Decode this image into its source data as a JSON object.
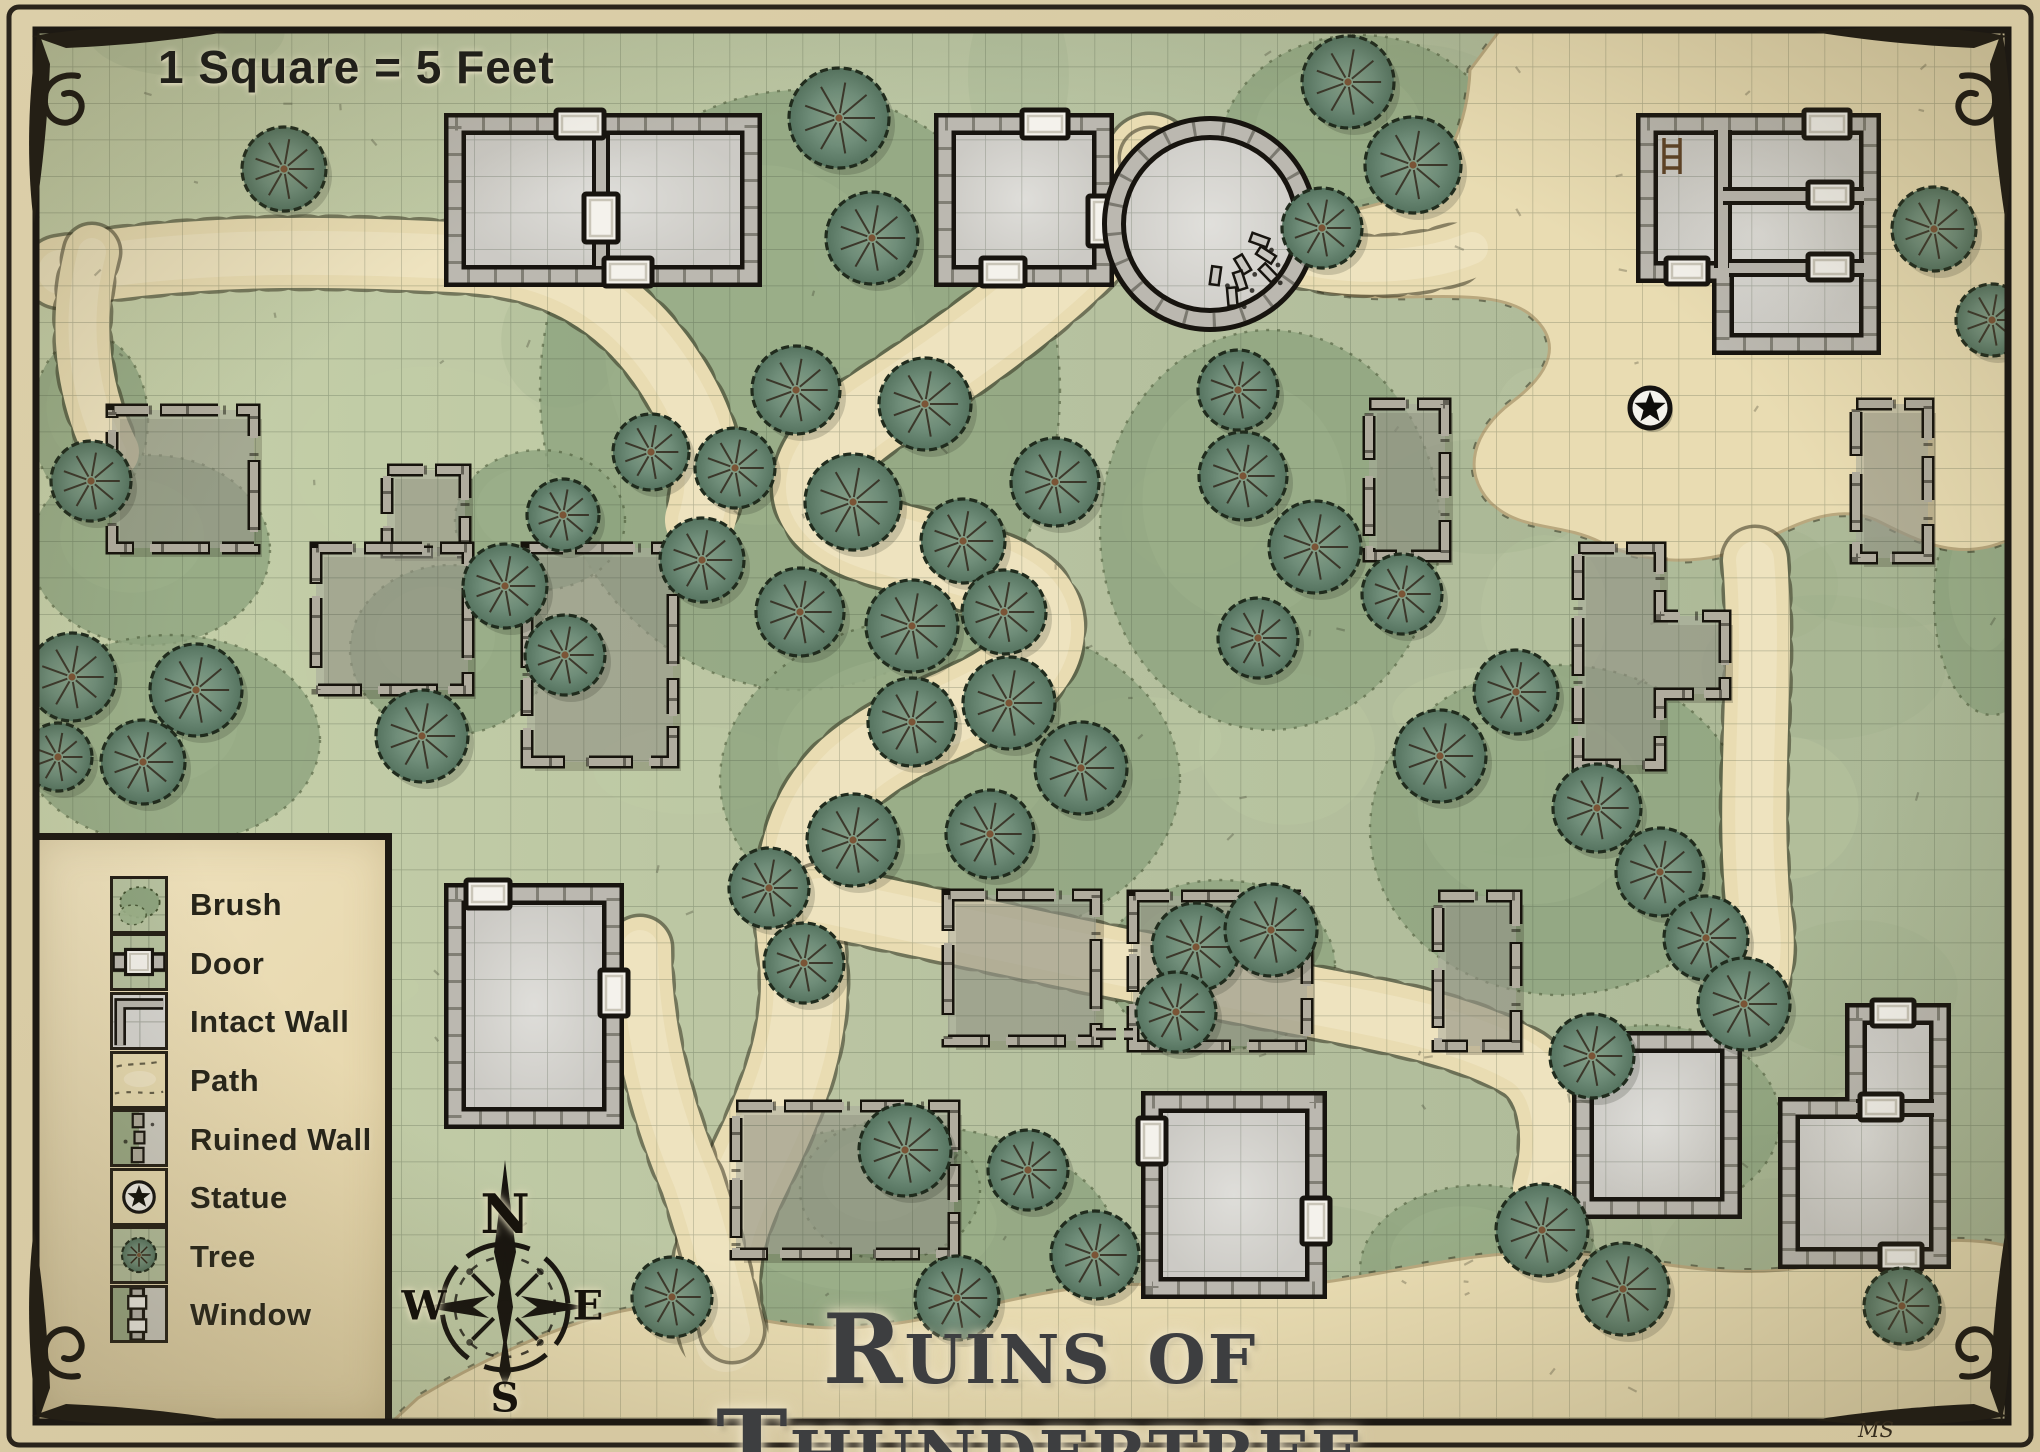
{
  "title": "Ruins of Thundertree",
  "scale_note": "1 Square = 5 Feet",
  "artist_mark": "MS",
  "compass": {
    "north": "N",
    "east": "E",
    "south": "S",
    "west": "W"
  },
  "legend": {
    "items": [
      {
        "label": "Brush",
        "icon": "brush-swatch"
      },
      {
        "label": "Door",
        "icon": "door-swatch"
      },
      {
        "label": "Intact Wall",
        "icon": "intact-wall-swatch"
      },
      {
        "label": "Path",
        "icon": "path-swatch"
      },
      {
        "label": "Ruined Wall",
        "icon": "ruined-wall-swatch"
      },
      {
        "label": "Statue",
        "icon": "statue-swatch"
      },
      {
        "label": "Tree",
        "icon": "tree-swatch"
      },
      {
        "label": "Window",
        "icon": "window-swatch"
      }
    ]
  },
  "colors": {
    "grass": "#b7c2a0",
    "grass_light": "#c6d0a9",
    "grass_dark": "#9cab87",
    "brush": "#8ea47f",
    "brush_ink": "#42502f",
    "tree_mid": "#6f8d79",
    "tree_light": "#87a189",
    "tree_dark": "#55735f",
    "path": "#e9dcb2",
    "path_light": "#f0e5c4",
    "path_edge": "#b9a87e",
    "floor": "#d7d6d2",
    "floor_light": "#e3e2de",
    "floor_dark": "#c6c4be",
    "wall_stone": "#bbb8b0",
    "ruin_stone": "#b0ac9e",
    "ink": "#17140f",
    "door_white": "#f4f2ec",
    "parchment": "#e7d9b4",
    "frame": "#241f15",
    "title_color": "#3d3e40"
  },
  "map": {
    "width": 2040,
    "height": 1452,
    "bounds": {
      "x": 36,
      "y": 30,
      "w": 1972,
      "h": 1392
    },
    "grid": {
      "size": 36.5,
      "line": "rgba(55,70,50,0.30)"
    },
    "path_fills": [
      {
        "d": "M1500,30 L2008,30 L2008,540 C1960,562 1920,542 1880,522 C1840,502 1800,522 1760,542 C1700,570 1640,562 1600,542 C1560,522 1520,532 1490,502 C1462,472 1472,432 1512,402 C1552,372 1562,342 1532,316 C1492,282 1400,306 1330,292 C1288,284 1272,258 1286,238 C1300,216 1352,214 1398,198 C1448,180 1468,120 1470,70 Z"
      },
      {
        "d": "M392,1422 L2008,1422 L2008,1246 C1930,1228 1868,1258 1798,1268 C1718,1280 1648,1258 1568,1253 C1478,1248 1398,1273 1318,1283 C1238,1293 1158,1278 1078,1288 C998,1298 918,1328 838,1328 C758,1328 698,1298 638,1308 C558,1321 468,1368 418,1398 Z"
      }
    ],
    "path_strokes": [
      {
        "d": "M1150,158 C1120,240 1000,330 880,408 C800,460 790,515 878,542 C968,568 1052,578 1040,640 C1028,702 918,712 850,772 C802,818 792,882 802,952 C812,1032 782,1102 748,1172 C718,1232 706,1282 726,1342",
        "w": 86
      },
      {
        "d": "M820,900 C960,930 1120,964 1262,992 C1370,1014 1460,1026 1524,1064 C1556,1086 1562,1140 1548,1188",
        "w": 70
      },
      {
        "d": "M60,272 C210,246 360,252 470,258 C562,264 622,304 664,364 C704,422 716,470 700,520",
        "w": 70
      },
      {
        "d": "M92,252 C74,322 82,392 112,452",
        "w": 54
      },
      {
        "d": "M640,948 C640,1030 662,1112 692,1182 C712,1242 722,1284 732,1330",
        "w": 62
      },
      {
        "d": "M1755,560 C1765,680 1745,800 1760,920 C1766,962 1756,992 1740,1012",
        "w": 64
      },
      {
        "d": "M1150,158 C1180,200 1232,240 1302,258 C1362,272 1430,266 1472,248",
        "w": 58
      }
    ],
    "brush": [
      [
        800,
        390,
        260,
        300
      ],
      [
        1270,
        530,
        170,
        200
      ],
      [
        1360,
        150,
        140,
        115
      ],
      [
        150,
        550,
        120,
        95
      ],
      [
        170,
        740,
        150,
        105
      ],
      [
        950,
        780,
        230,
        165
      ],
      [
        900,
        1240,
        215,
        115
      ],
      [
        1560,
        830,
        190,
        165
      ],
      [
        1650,
        1120,
        130,
        95
      ],
      [
        1220,
        965,
        115,
        85
      ],
      [
        450,
        650,
        100,
        85
      ],
      [
        1958,
        290,
        80,
        100
      ],
      [
        540,
        520,
        85,
        70
      ],
      [
        90,
        420,
        58,
        85
      ],
      [
        1992,
        600,
        58,
        115
      ],
      [
        1480,
        1270,
        120,
        85
      ],
      [
        890,
        1190,
        90,
        70
      ]
    ],
    "trees": [
      [
        284,
        169,
        42
      ],
      [
        839,
        118,
        50
      ],
      [
        872,
        238,
        46
      ],
      [
        1348,
        82,
        46
      ],
      [
        1413,
        165,
        48
      ],
      [
        1322,
        228,
        40
      ],
      [
        1934,
        229,
        42
      ],
      [
        1992,
        320,
        36
      ],
      [
        651,
        452,
        38
      ],
      [
        735,
        468,
        40
      ],
      [
        796,
        390,
        44
      ],
      [
        925,
        404,
        46
      ],
      [
        853,
        502,
        48
      ],
      [
        963,
        541,
        42
      ],
      [
        1055,
        482,
        44
      ],
      [
        702,
        560,
        42
      ],
      [
        800,
        612,
        44
      ],
      [
        912,
        626,
        46
      ],
      [
        1004,
        612,
        42
      ],
      [
        563,
        515,
        36
      ],
      [
        505,
        586,
        42
      ],
      [
        565,
        655,
        40
      ],
      [
        422,
        736,
        46
      ],
      [
        1238,
        390,
        40
      ],
      [
        1243,
        476,
        44
      ],
      [
        1315,
        547,
        46
      ],
      [
        1402,
        594,
        40
      ],
      [
        1258,
        638,
        40
      ],
      [
        91,
        481,
        40
      ],
      [
        72,
        677,
        44
      ],
      [
        196,
        690,
        46
      ],
      [
        143,
        762,
        42
      ],
      [
        58,
        757,
        34
      ],
      [
        912,
        722,
        44
      ],
      [
        1009,
        703,
        46
      ],
      [
        1081,
        768,
        46
      ],
      [
        990,
        834,
        44
      ],
      [
        853,
        840,
        46
      ],
      [
        769,
        888,
        40
      ],
      [
        804,
        963,
        40
      ],
      [
        1196,
        947,
        44
      ],
      [
        1271,
        930,
        46
      ],
      [
        1176,
        1012,
        40
      ],
      [
        1440,
        756,
        46
      ],
      [
        1516,
        692,
        42
      ],
      [
        1597,
        808,
        44
      ],
      [
        1660,
        872,
        44
      ],
      [
        1706,
        938,
        42
      ],
      [
        1592,
        1056,
        42
      ],
      [
        1744,
        1004,
        46
      ],
      [
        905,
        1150,
        46
      ],
      [
        672,
        1297,
        40
      ],
      [
        957,
        1298,
        42
      ],
      [
        1095,
        1255,
        44
      ],
      [
        1028,
        1170,
        40
      ],
      [
        1542,
        1230,
        46
      ],
      [
        1623,
        1289,
        46
      ],
      [
        1902,
        1306,
        38
      ]
    ],
    "buildings": [
      {
        "id": "hall-nw",
        "type": "intact",
        "x": 455,
        "y": 124,
        "w": 296,
        "h": 152,
        "inner_walls": [
          [
            601,
            134,
            601,
            266
          ]
        ],
        "doors": [
          [
            556,
            110,
            48,
            28
          ],
          [
            584,
            194,
            34,
            48
          ],
          [
            604,
            258,
            48,
            28
          ]
        ]
      },
      {
        "id": "tower-house",
        "type": "intact",
        "x": 945,
        "y": 124,
        "w": 158,
        "h": 152,
        "doors": [
          [
            1022,
            110,
            46,
            28
          ],
          [
            981,
            258,
            44,
            28
          ],
          [
            1088,
            196,
            28,
            50
          ]
        ]
      },
      {
        "id": "round-tower",
        "type": "tower",
        "cx": 1210,
        "cy": 224,
        "r": 96
      },
      {
        "id": "keep-ne",
        "type": "intact",
        "points": [
          [
            1647,
            124
          ],
          [
            1870,
            124
          ],
          [
            1870,
            344
          ],
          [
            1723,
            344
          ],
          [
            1723,
            272
          ],
          [
            1647,
            272
          ]
        ],
        "inner_walls": [
          [
            1723,
            130,
            1723,
            268
          ],
          [
            1723,
            196,
            1864,
            196
          ],
          [
            1729,
            268,
            1864,
            268
          ]
        ],
        "doors": [
          [
            1804,
            110,
            46,
            28
          ],
          [
            1808,
            182,
            44,
            26
          ],
          [
            1666,
            258,
            42,
            26
          ],
          [
            1808,
            254,
            44,
            26
          ]
        ],
        "ladder": [
          1664,
          138
        ]
      },
      {
        "id": "ruin-w",
        "type": "ruined",
        "x": 112,
        "y": 410,
        "w": 142,
        "h": 138,
        "doors": []
      },
      {
        "id": "ruin-wm-a",
        "type": "ruined",
        "x": 387,
        "y": 470,
        "w": 78,
        "h": 82,
        "doors": []
      },
      {
        "id": "ruin-wm-b",
        "type": "ruined",
        "x": 316,
        "y": 548,
        "w": 152,
        "h": 142,
        "doors": []
      },
      {
        "id": "ruin-wm-c",
        "type": "ruined",
        "x": 527,
        "y": 548,
        "w": 146,
        "h": 214,
        "doors": []
      },
      {
        "id": "ruin-c",
        "type": "ruined",
        "x": 1369,
        "y": 404,
        "w": 76,
        "h": 152,
        "doors": []
      },
      {
        "id": "ruin-e",
        "type": "ruined",
        "x": 1856,
        "y": 404,
        "w": 72,
        "h": 154,
        "doors": []
      },
      {
        "id": "ruin-farm-e",
        "type": "ruined",
        "points": [
          [
            1578,
            548
          ],
          [
            1660,
            548
          ],
          [
            1660,
            616
          ],
          [
            1725,
            616
          ],
          [
            1725,
            694
          ],
          [
            1660,
            694
          ],
          [
            1660,
            765
          ],
          [
            1578,
            765
          ]
        ],
        "doors": []
      },
      {
        "id": "barn-sw",
        "type": "intact",
        "x": 455,
        "y": 894,
        "w": 158,
        "h": 224,
        "doors": [
          [
            466,
            880,
            44,
            28
          ],
          [
            600,
            970,
            28,
            46
          ]
        ]
      },
      {
        "id": "ruin-sc-a",
        "type": "ruined",
        "x": 948,
        "y": 895,
        "w": 148,
        "h": 146,
        "doors": []
      },
      {
        "id": "ruin-sc-b",
        "type": "ruined",
        "x": 1133,
        "y": 896,
        "w": 174,
        "h": 150,
        "doors": []
      },
      {
        "id": "ruin-sc-c",
        "type": "ruined",
        "x": 1438,
        "y": 896,
        "w": 78,
        "h": 150,
        "doors": []
      },
      {
        "id": "ruin-s",
        "type": "ruined",
        "x": 736,
        "y": 1106,
        "w": 218,
        "h": 148,
        "doors": []
      },
      {
        "id": "house-s",
        "type": "intact",
        "x": 1152,
        "y": 1102,
        "w": 164,
        "h": 186,
        "doors": [
          [
            1138,
            1118,
            28,
            46
          ],
          [
            1302,
            1198,
            28,
            46
          ]
        ]
      },
      {
        "id": "house-se",
        "type": "intact",
        "x": 1583,
        "y": 1042,
        "w": 148,
        "h": 166,
        "doors": []
      },
      {
        "id": "house-far-se",
        "type": "intact",
        "points": [
          [
            1856,
            1014
          ],
          [
            1940,
            1014
          ],
          [
            1940,
            1258
          ],
          [
            1789,
            1258
          ],
          [
            1789,
            1108
          ],
          [
            1856,
            1108
          ]
        ],
        "inner_walls": [
          [
            1856,
            1108,
            1934,
            1108
          ]
        ],
        "doors": [
          [
            1872,
            1000,
            42,
            26
          ],
          [
            1860,
            1094,
            42,
            26
          ],
          [
            1880,
            1244,
            42,
            26
          ]
        ]
      }
    ],
    "ruined_walls": [
      [
        1096,
        1034,
        1133,
        1034
      ]
    ],
    "statue": {
      "x": 1650,
      "y": 408,
      "r": 20
    },
    "compass": {
      "cx": 505,
      "cy": 1307,
      "r": 63
    }
  }
}
